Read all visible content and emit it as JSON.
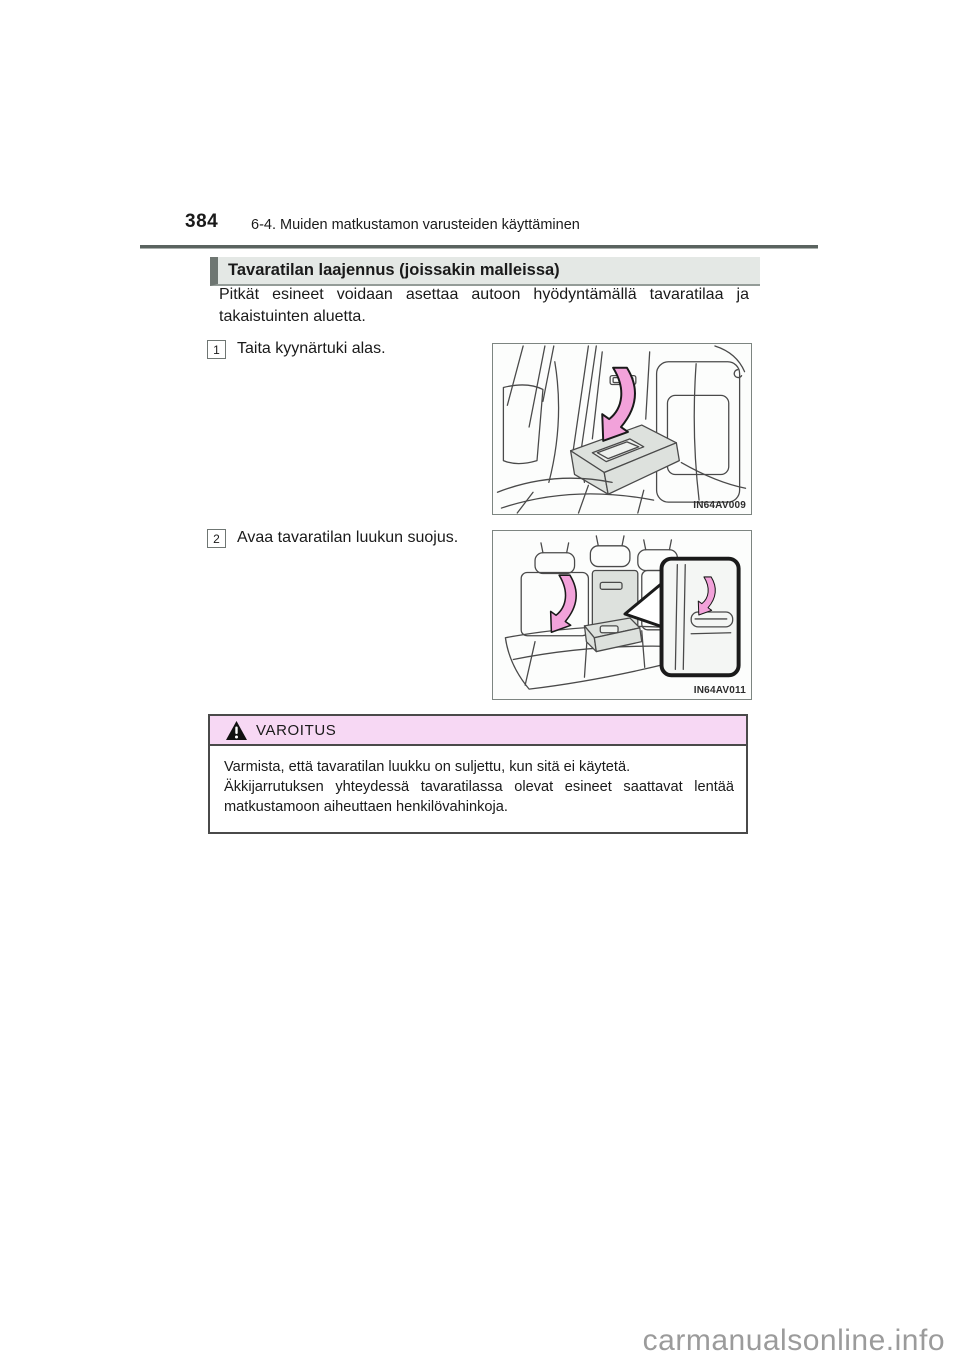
{
  "page": {
    "number": "384",
    "header": "6-4. Muiden matkustamon varusteiden käyttäminen"
  },
  "section": {
    "title": "Tavaratilan laajennus (joissakin malleissa)",
    "intro": "Pitkät esineet voidaan asettaa autoon hyödyntämällä tavaratilaa ja takaistuinten aluetta.",
    "steps": [
      {
        "number": "1",
        "text": "Taita kyynärtuki alas.",
        "figure_label": "IN64AV009"
      },
      {
        "number": "2",
        "text": "Avaa tavaratilan luukun suojus.",
        "figure_label": "IN64AV011"
      }
    ]
  },
  "warning": {
    "icon": "warning-triangle-icon",
    "title": "VAROITUS",
    "lines": [
      "Varmista, että tavaratilan luukku on suljettu, kun sitä ei käytetä.",
      "Äkkijarrutuksen yhteydessä tavaratilassa olevat esineet saattavat lentää matkustamoon aiheuttaen henkilövahinkoja."
    ]
  },
  "watermark": "carmanualsonline.info",
  "colors": {
    "header_rule": "#5a635f",
    "section_header_bg": "#e4e8e5",
    "section_header_bar": "#6e7672",
    "warning_header_bg": "#f7d8f4",
    "arrow_pink": "#f2a2da",
    "watermark_gray": "#9b9b9b"
  }
}
